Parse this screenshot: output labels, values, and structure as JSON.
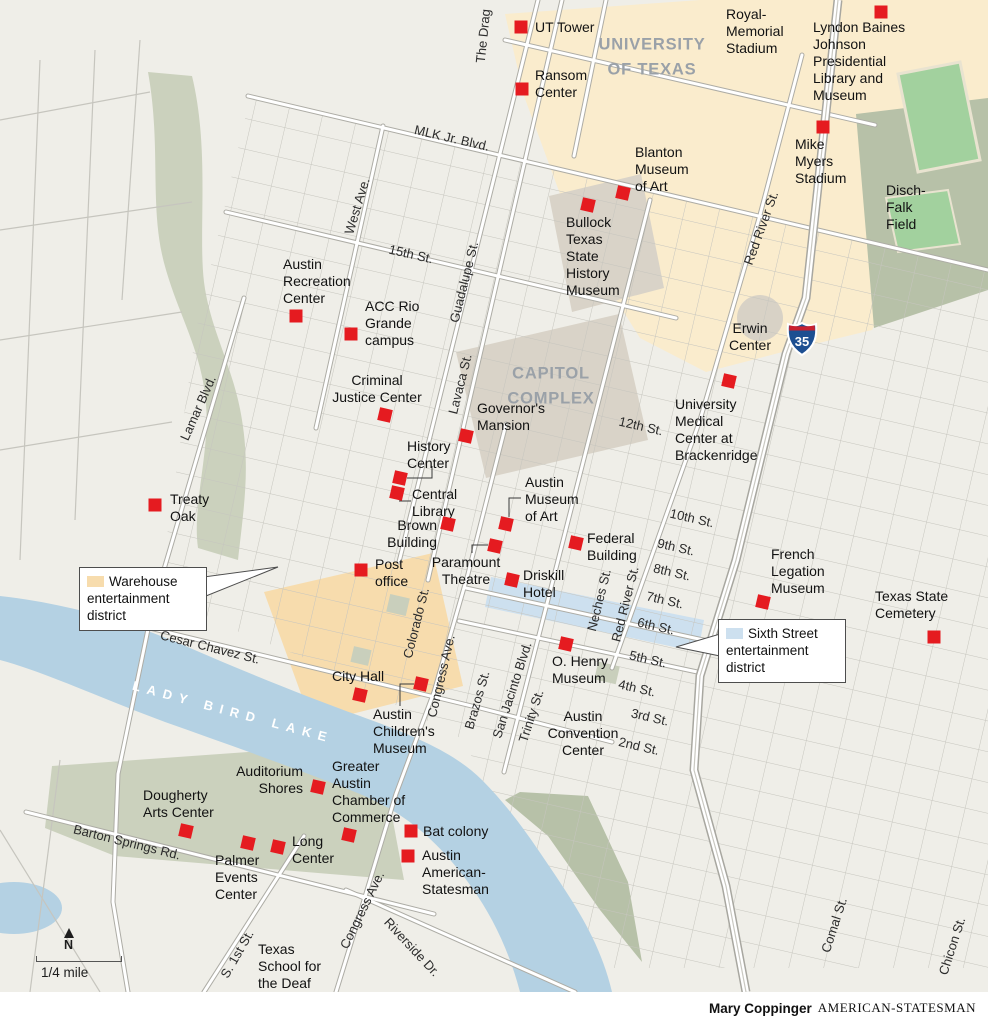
{
  "credit": {
    "author": "Mary Coppinger",
    "publication": "AMERICAN-STATESMAN"
  },
  "scale": {
    "north_label": "N",
    "distance_label": "1/4 mile"
  },
  "highway": {
    "shield": "35"
  },
  "colors": {
    "marker": "#e51b20",
    "campus": "#faeccd",
    "capitol_complex": "#d9d3c8",
    "warehouse_district": "#f7dcad",
    "sixth_street_district": "#cde0ef",
    "park": "#cbd1bd",
    "park_dark": "#b7c1a8",
    "field_green": "#a2d19e",
    "water": "#b4d1e3",
    "area_label_gray": "#9aa1a8"
  },
  "callouts": [
    {
      "id": "warehouse-district",
      "swatch_color": "#f7dcad",
      "text": "Warehouse\nentertainment\ndistrict"
    },
    {
      "id": "sixth-street-district",
      "swatch_color": "#cde0ef",
      "text": "Sixth Street\nentertainment\ndistrict"
    }
  ],
  "area_labels": [
    {
      "text": "UNIVERSITY\nOF TEXAS",
      "x": 652,
      "y": 57,
      "style": "big"
    },
    {
      "text": "CAPITOL\nCOMPLEX",
      "x": 551,
      "y": 386,
      "style": "big"
    },
    {
      "text": "LADY BIRD LAKE",
      "x": 233,
      "y": 712,
      "style": "water",
      "rot": 15
    },
    {
      "text": "Erwin\nCenter",
      "x": 750,
      "y": 320,
      "style": "place",
      "align": "center"
    },
    {
      "text": "Royal-\nMemorial\nStadium",
      "x": 726,
      "y": 6,
      "style": "place",
      "align": "left"
    },
    {
      "text": "Disch-\nFalk\nField",
      "x": 886,
      "y": 182,
      "style": "place",
      "align": "left"
    },
    {
      "text": "Austin\nConvention\nCenter",
      "x": 583,
      "y": 708,
      "style": "place",
      "align": "center"
    },
    {
      "text": "Texas\nSchool for\nthe Deaf",
      "x": 258,
      "y": 941,
      "style": "place",
      "align": "left"
    }
  ],
  "street_labels": [
    {
      "text": "The Drag",
      "x": 483,
      "y": 36,
      "rot": -84
    },
    {
      "text": "MLK Jr. Blvd.",
      "x": 452,
      "y": 138,
      "rot": 13
    },
    {
      "text": "West Ave.",
      "x": 357,
      "y": 206,
      "rot": -73
    },
    {
      "text": "15th St.",
      "x": 411,
      "y": 254,
      "rot": 13
    },
    {
      "text": "Guadalupe St.",
      "x": 464,
      "y": 282,
      "rot": -76
    },
    {
      "text": "Lavaca St.",
      "x": 460,
      "y": 384,
      "rot": -76
    },
    {
      "text": "Red River St.",
      "x": 761,
      "y": 228,
      "rot": -70
    },
    {
      "text": "Lamar Blvd.",
      "x": 198,
      "y": 408,
      "rot": -66
    },
    {
      "text": "12th St.",
      "x": 641,
      "y": 426,
      "rot": 13
    },
    {
      "text": "10th St.",
      "x": 692,
      "y": 518,
      "rot": 13
    },
    {
      "text": "9th St.",
      "x": 676,
      "y": 547,
      "rot": 13
    },
    {
      "text": "8th St.",
      "x": 672,
      "y": 572,
      "rot": 13
    },
    {
      "text": "7th St.",
      "x": 665,
      "y": 600,
      "rot": 13
    },
    {
      "text": "6th St.",
      "x": 656,
      "y": 626,
      "rot": 13
    },
    {
      "text": "5th St.",
      "x": 648,
      "y": 659,
      "rot": 13
    },
    {
      "text": "4th St.",
      "x": 637,
      "y": 688,
      "rot": 13
    },
    {
      "text": "3rd St.",
      "x": 650,
      "y": 717,
      "rot": 13
    },
    {
      "text": "2nd St.",
      "x": 639,
      "y": 746,
      "rot": 13
    },
    {
      "text": "Neches St.",
      "x": 599,
      "y": 600,
      "rot": -76
    },
    {
      "text": "Red River St.",
      "x": 625,
      "y": 604,
      "rot": -76
    },
    {
      "text": "Brazos St.",
      "x": 477,
      "y": 700,
      "rot": -74
    },
    {
      "text": "Colorado St.",
      "x": 416,
      "y": 623,
      "rot": -76
    },
    {
      "text": "Congress Ave.",
      "x": 441,
      "y": 676,
      "rot": -77
    },
    {
      "text": "San Jacinto Blvd.",
      "x": 512,
      "y": 690,
      "rot": -72
    },
    {
      "text": "Trinity St.",
      "x": 531,
      "y": 716,
      "rot": -72
    },
    {
      "text": "Cesar Chavez St.",
      "x": 210,
      "y": 647,
      "rot": 14
    },
    {
      "text": "Barton Springs Rd.",
      "x": 127,
      "y": 842,
      "rot": 14
    },
    {
      "text": "Congress Ave.",
      "x": 362,
      "y": 910,
      "rot": -64
    },
    {
      "text": "Riverside Dr.",
      "x": 412,
      "y": 947,
      "rot": 47
    },
    {
      "text": "S. 1st St.",
      "x": 237,
      "y": 954,
      "rot": -60
    },
    {
      "text": "Comal St.",
      "x": 834,
      "y": 925,
      "rot": -72
    },
    {
      "text": "Chicon St.",
      "x": 952,
      "y": 946,
      "rot": -72
    }
  ],
  "landmarks": [
    {
      "text": "UT Tower",
      "tx": 535,
      "ty": 19,
      "align": "left",
      "mx": 521,
      "my": 27,
      "rot": 0
    },
    {
      "text": "Ransom\nCenter",
      "tx": 535,
      "ty": 67,
      "align": "left",
      "mx": 522,
      "my": 89,
      "rot": 0
    },
    {
      "text": "Lyndon Baines\nJohnson\nPresidential\nLibrary and\nMuseum",
      "tx": 813,
      "ty": 19,
      "align": "left",
      "mx": 881,
      "my": 12,
      "rot": 0
    },
    {
      "text": "Mike\nMyers\nStadium",
      "tx": 795,
      "ty": 136,
      "align": "left",
      "mx": 823,
      "my": 127,
      "rot": 0
    },
    {
      "text": "Blanton\nMuseum\nof Art",
      "tx": 635,
      "ty": 144,
      "align": "left",
      "mx": 623,
      "my": 193,
      "rot": 13
    },
    {
      "text": "Bullock\nTexas\nState\nHistory\nMuseum",
      "tx": 566,
      "ty": 214,
      "align": "left",
      "mx": 588,
      "my": 205,
      "rot": 13
    },
    {
      "text": "Austin\nRecreation\nCenter",
      "tx": 283,
      "ty": 256,
      "align": "left",
      "mx": 296,
      "my": 316,
      "rot": 0
    },
    {
      "text": "ACC Rio\nGrande\ncampus",
      "tx": 365,
      "ty": 298,
      "align": "left",
      "mx": 351,
      "my": 334,
      "rot": 0
    },
    {
      "text": "Criminal\nJustice Center",
      "tx": 377,
      "ty": 372,
      "align": "center",
      "mx": 385,
      "my": 415,
      "rot": 13
    },
    {
      "text": "Governor's\nMansion",
      "tx": 477,
      "ty": 400,
      "align": "left",
      "mx": 466,
      "my": 436,
      "rot": 13
    },
    {
      "text": "University\nMedical\nCenter at\nBrackenridge",
      "tx": 675,
      "ty": 396,
      "align": "left",
      "mx": 729,
      "my": 381,
      "rot": 13
    },
    {
      "text": "History\nCenter",
      "tx": 407,
      "ty": 438,
      "align": "left",
      "mx": 400,
      "my": 478,
      "rot": 13,
      "conn": [
        [
          432,
          466
        ],
        [
          432,
          478
        ],
        [
          407,
          478
        ]
      ]
    },
    {
      "text": "Central\nLibrary",
      "tx": 412,
      "ty": 486,
      "align": "left",
      "mx": 397,
      "my": 493,
      "rot": 13,
      "conn": [
        [
          411,
          501
        ],
        [
          399,
          501
        ]
      ]
    },
    {
      "text": "Brown\nBuilding",
      "tx": 437,
      "ty": 517,
      "align": "right",
      "mx": 448,
      "my": 524,
      "rot": 13
    },
    {
      "text": "Austin\nMuseum\nof Art",
      "tx": 525,
      "ty": 474,
      "align": "left",
      "mx": 506,
      "my": 524,
      "rot": 13,
      "conn": [
        [
          521,
          498
        ],
        [
          509,
          498
        ],
        [
          509,
          517
        ]
      ]
    },
    {
      "text": "Paramount\nTheatre",
      "tx": 466,
      "ty": 554,
      "align": "center",
      "mx": 495,
      "my": 546,
      "rot": 13,
      "conn": [
        [
          472,
          553
        ],
        [
          472,
          545
        ],
        [
          488,
          545
        ]
      ]
    },
    {
      "text": "Federal\nBuilding",
      "tx": 587,
      "ty": 530,
      "align": "left",
      "mx": 576,
      "my": 543,
      "rot": 13
    },
    {
      "text": "Post\noffice",
      "tx": 375,
      "ty": 556,
      "align": "left",
      "mx": 361,
      "my": 570,
      "rot": 0
    },
    {
      "text": "Driskill\nHotel",
      "tx": 523,
      "ty": 567,
      "align": "left",
      "mx": 512,
      "my": 580,
      "rot": 13
    },
    {
      "text": "Treaty\nOak",
      "tx": 170,
      "ty": 491,
      "align": "left",
      "mx": 155,
      "my": 505,
      "rot": 0
    },
    {
      "text": "City Hall",
      "tx": 332,
      "ty": 668,
      "align": "left",
      "mx": 360,
      "my": 695,
      "rot": 13
    },
    {
      "text": "Austin\nChildren's\nMuseum",
      "tx": 373,
      "ty": 706,
      "align": "left",
      "mx": 421,
      "my": 684,
      "rot": 13,
      "conn": [
        [
          400,
          706
        ],
        [
          400,
          684
        ],
        [
          414,
          684
        ]
      ]
    },
    {
      "text": "O. Henry\nMuseum",
      "tx": 552,
      "ty": 653,
      "align": "left",
      "mx": 566,
      "my": 644,
      "rot": 13
    },
    {
      "text": "French\nLegation\nMuseum",
      "tx": 771,
      "ty": 546,
      "align": "left",
      "mx": 763,
      "my": 602,
      "rot": 13
    },
    {
      "text": "Texas State\nCemetery",
      "tx": 875,
      "ty": 588,
      "align": "left",
      "mx": 934,
      "my": 637,
      "rot": 0
    },
    {
      "text": "Auditorium\nShores",
      "tx": 303,
      "ty": 763,
      "align": "right",
      "mx": 318,
      "my": 787,
      "rot": 13
    },
    {
      "text": "Dougherty\nArts Center",
      "tx": 143,
      "ty": 787,
      "align": "left",
      "mx": 186,
      "my": 831,
      "rot": 13
    },
    {
      "text": "Palmer\nEvents\nCenter",
      "tx": 215,
      "ty": 852,
      "align": "left",
      "mx": 248,
      "my": 843,
      "rot": 13
    },
    {
      "text": "Long\nCenter",
      "tx": 292,
      "ty": 833,
      "align": "left",
      "mx": 278,
      "my": 847,
      "rot": 13
    },
    {
      "text": "Greater\nAustin\nChamber of\nCommerce",
      "tx": 332,
      "ty": 758,
      "align": "left",
      "mx": 349,
      "my": 835,
      "rot": 13
    },
    {
      "text": "Bat colony",
      "tx": 423,
      "ty": 823,
      "align": "left",
      "mx": 411,
      "my": 831,
      "rot": 0
    },
    {
      "text": "Austin\nAmerican-\nStatesman",
      "tx": 422,
      "ty": 847,
      "align": "left",
      "mx": 408,
      "my": 856,
      "rot": 0
    }
  ]
}
